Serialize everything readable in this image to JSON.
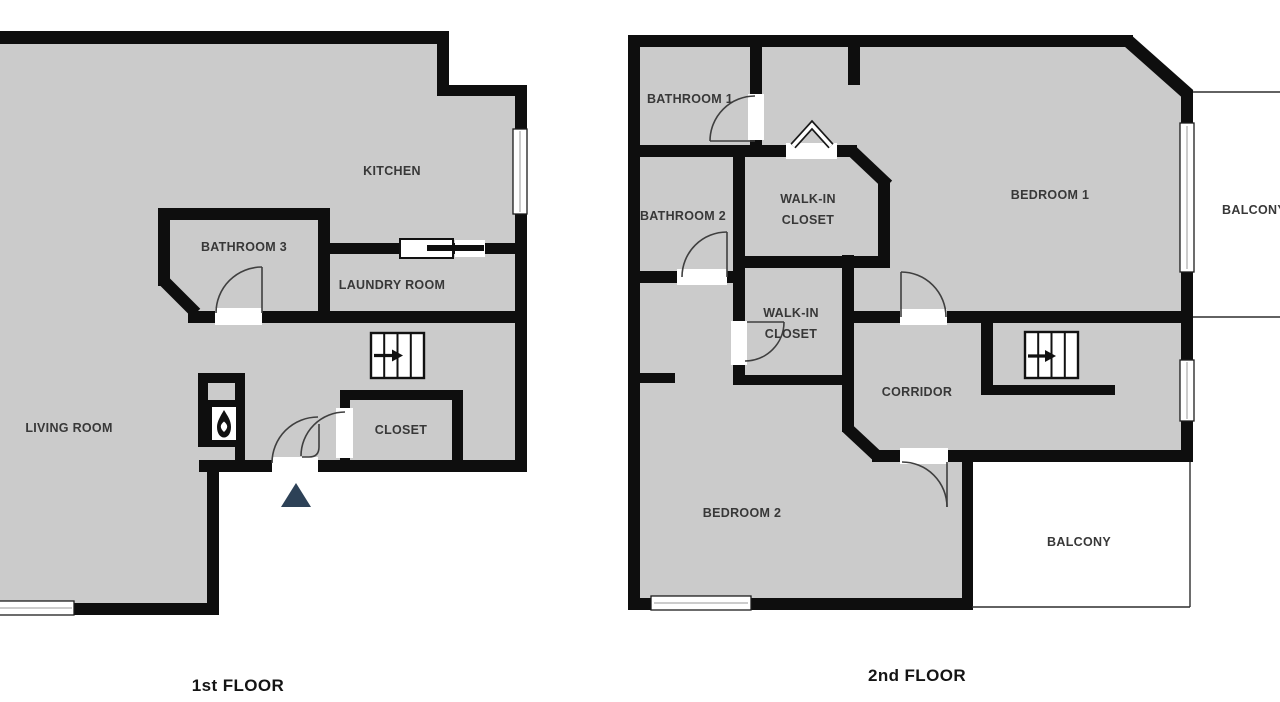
{
  "colors": {
    "floor": "#cbcbcb",
    "wall": "#0e0e0e",
    "label": "#383838",
    "title": "#141414",
    "entrance": "#2d4157"
  },
  "first_floor": {
    "title": "1st FLOOR",
    "rooms": {
      "kitchen": "KITCHEN",
      "bathroom_3": "BATHROOM 3",
      "laundry_room": "LAUNDRY ROOM",
      "living_room": "LIVING ROOM",
      "closet": "CLOSET"
    }
  },
  "second_floor": {
    "title": "2nd FLOOR",
    "rooms": {
      "bathroom_1": "BATHROOM 1",
      "bathroom_2": "BATHROOM 2",
      "walk_in_closet_1_line1": "WALK-IN",
      "walk_in_closet_1_line2": "CLOSET",
      "walk_in_closet_2_line1": "WALK-IN",
      "walk_in_closet_2_line2": "CLOSET",
      "bedroom_1": "BEDROOM 1",
      "bedroom_2": "BEDROOM 2",
      "corridor": "CORRIDOR",
      "balcony_right": "BALCONY",
      "balcony_bottom": "BALCONY"
    }
  },
  "icons": {
    "stairs": "stairs-icon: treads with right direction arrow",
    "fireplace": "fireplace-icon: flame glyph in firebox",
    "entrance": "entrance-arrow-icon: solid navy triangle",
    "bifold_door": "bifold-door-icon: outlined chevron",
    "door_swing": "door-swing-arc: quarter circle",
    "window": "window: white double-line bar in wall"
  }
}
